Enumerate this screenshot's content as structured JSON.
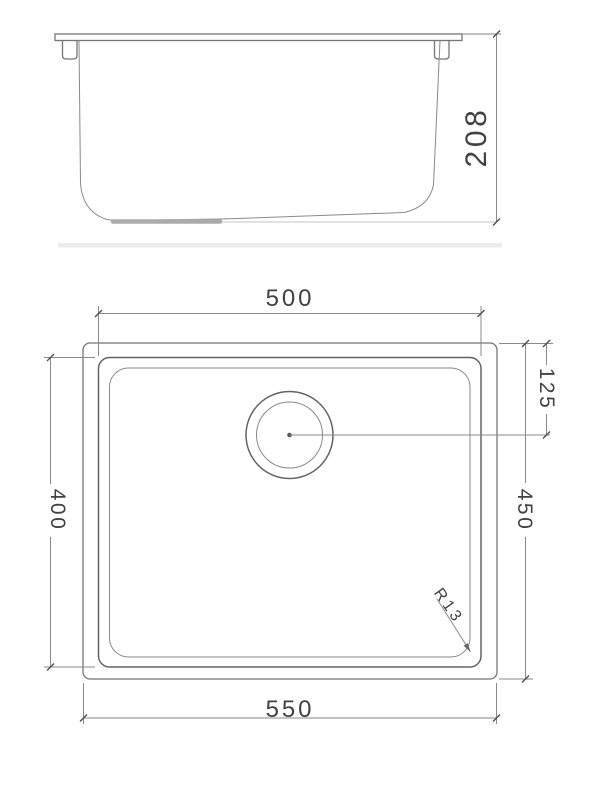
{
  "dims": {
    "side_height": "208",
    "bowl_width": "500",
    "bowl_length": "400",
    "overall_length": "450",
    "drain_offset": "125",
    "overall_width": "550",
    "corner_radius": "R13"
  },
  "colors": {
    "background": "#ffffff",
    "drawing_line": "#757575",
    "thin_line": "#8a8a8a",
    "faint_line": "#c6c6c6",
    "dimension_text": "#424242",
    "drain_recess_bar": "#ababab"
  }
}
